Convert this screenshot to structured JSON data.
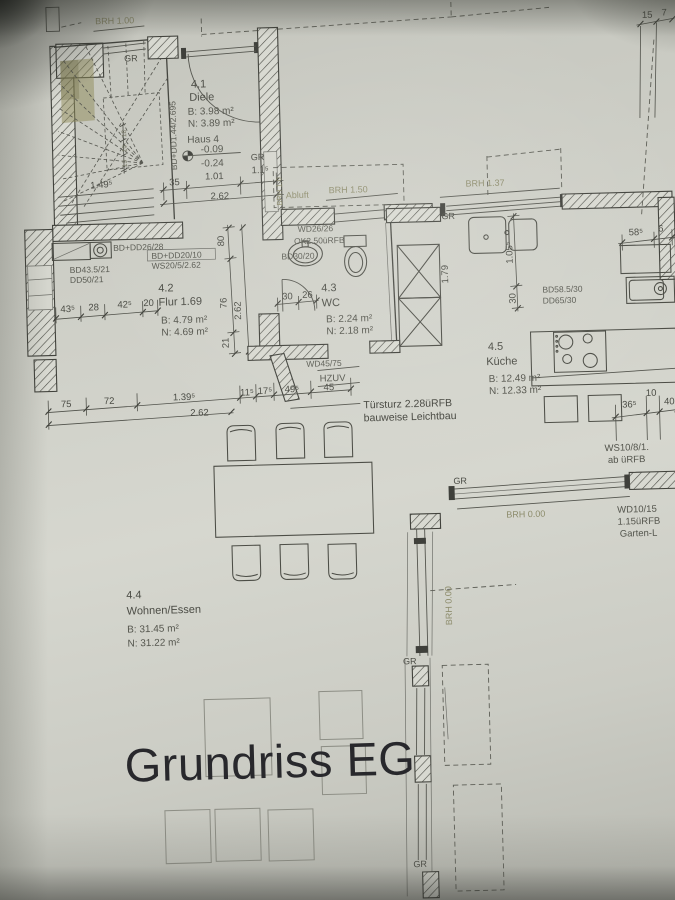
{
  "title": "Grundriss EG",
  "rooms": {
    "diele": {
      "num": "4.1",
      "name": "Diele",
      "b": "B: 3.98 m²",
      "n": "N: 3.89 m²"
    },
    "flur": {
      "num": "4.2",
      "name": "Flur 1.69",
      "b": "B: 4.79 m²",
      "n": "N: 4.69 m²"
    },
    "wc": {
      "num": "4.3",
      "name": "WC",
      "b": "B: 2.24 m²",
      "n": "N: 2.18 m²"
    },
    "wohnen": {
      "num": "4.4",
      "name": "Wohnen/Essen",
      "b": "B: 31.45 m²",
      "n": "N: 31.22 m²"
    },
    "kueche": {
      "num": "4.5",
      "name": "Küche",
      "b": "B: 12.49 m²",
      "n": "N: 12.33 m²"
    }
  },
  "haus": {
    "label": "Haus 4",
    "upper": "-0.09",
    "lower": "-0.24"
  },
  "brh": {
    "entry": "BRH 1.00",
    "abluft": "Abluft",
    "wc": "BRH 1.50",
    "wc_v": "BRH 1.0",
    "kitchen": "BRH 1.37",
    "garden": "BRH 0.00",
    "garden_v": "BRH 0.00"
  },
  "labels": {
    "gr": "GR",
    "bd_dd144": "BD+DD1.44/2.695",
    "bd_dd26": "BD+DD26/28",
    "bd_dd20": "BD+DD20/10",
    "ws20": "WS20/5/2.62",
    "bd43": "BD43.5/21",
    "dd50": "DD50/21",
    "wd26": "WD26/26",
    "ok250": "OK2.50üRFB",
    "bd30": "BD30/20",
    "wd45": "WD45/75",
    "hzuv": "HZUV",
    "bd58": "BD58.5/30",
    "dd65": "DD65/30",
    "ws10": "WS10/8/1.",
    "ab_urfb": "ab üRFB",
    "wd10": "WD10/15",
    "urfb115": "1.15üRFB",
    "garten": "Garten-L",
    "tuersturz1": "Türsturz 2.28üRFB",
    "tuersturz2": "bauweise Leichtbau"
  },
  "dims": {
    "top": [
      "35",
      "1.01",
      "1.1⁵"
    ],
    "top_total": "2.62",
    "stair": "1.49⁵",
    "stair_steps": [
      "18",
      "10",
      "19"
    ],
    "corner": [
      "15",
      "7"
    ],
    "flur": [
      "43⁵",
      "28",
      "42⁵",
      "20"
    ],
    "flur_v": [
      "80",
      "76",
      "21"
    ],
    "flur_v_total": "2.62",
    "wc": [
      "30",
      "26"
    ],
    "kitchen_v": [
      "1.05⁵",
      "30"
    ],
    "kitchen_r": [
      "58⁵",
      "6"
    ],
    "cab": "1.79",
    "island": [
      "36⁵",
      "10",
      "40"
    ],
    "main": [
      "75",
      "72",
      "1.39⁵",
      "11⁵",
      "17⁵",
      "49⁵",
      "45"
    ],
    "main_total": "2.62"
  }
}
